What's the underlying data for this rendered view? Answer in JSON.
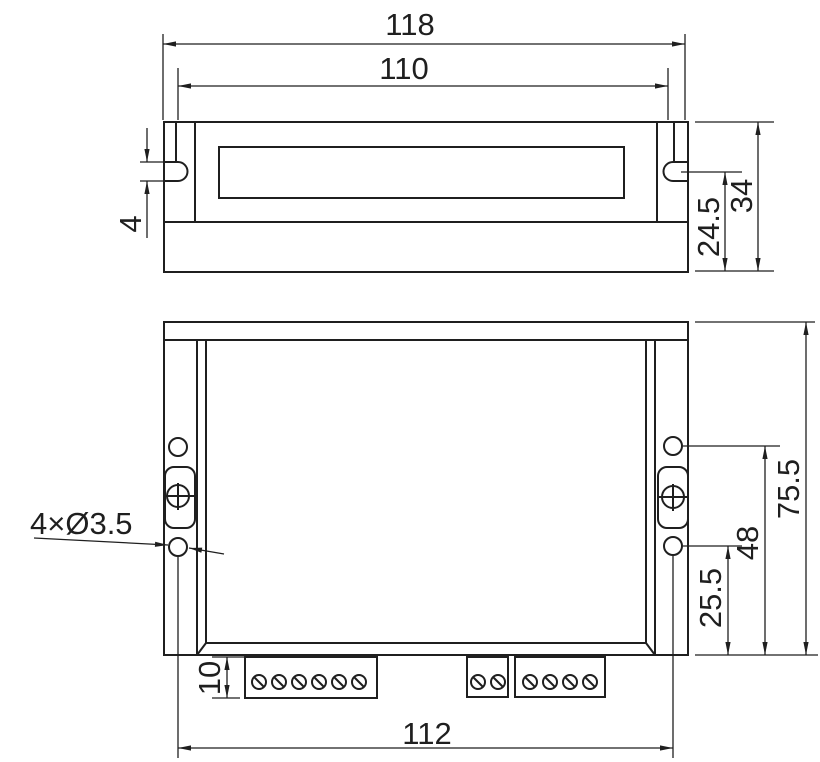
{
  "colors": {
    "background": "#ffffff",
    "line": "#1f1f1f"
  },
  "top_view": {
    "dim_overall_width": "118",
    "dim_body_width": "110",
    "dim_slot_width": "4",
    "dim_slot_to_base": "24.5",
    "dim_total_height": "34"
  },
  "front_view": {
    "hole_callout": "4×Ø3.5",
    "dim_total_height": "75.5",
    "dim_upper_hole_from_bottom": "48",
    "dim_lower_hole_from_bottom": "25.5",
    "dim_hole_spacing": "112",
    "dim_terminal_height": "10"
  }
}
